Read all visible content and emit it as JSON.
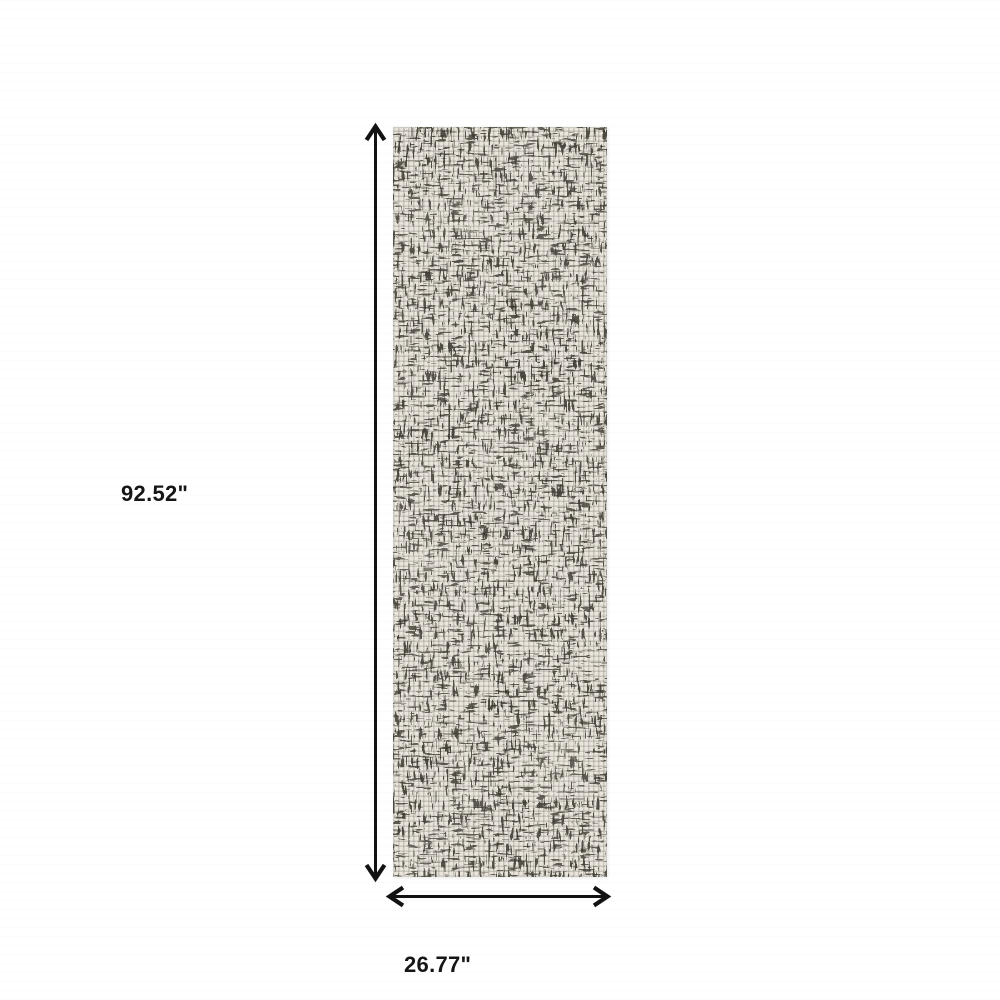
{
  "dimension_annotations": {
    "height": {
      "label": "92.52\"",
      "arrow_icon": "double-arrow-vertical-icon"
    },
    "width": {
      "label": "26.77\"",
      "arrow_icon": "double-arrow-horizontal-icon"
    }
  },
  "product_image": {
    "kind": "runner rug photo",
    "pattern": "distressed abstract crosshatch grid"
  },
  "colors": {
    "background": "#ffffff",
    "rug_base_ivory": "#e9e5dc",
    "rug_pattern_charcoal": "#39362e",
    "arrow_black": "#121212",
    "label_text": "#161616"
  }
}
